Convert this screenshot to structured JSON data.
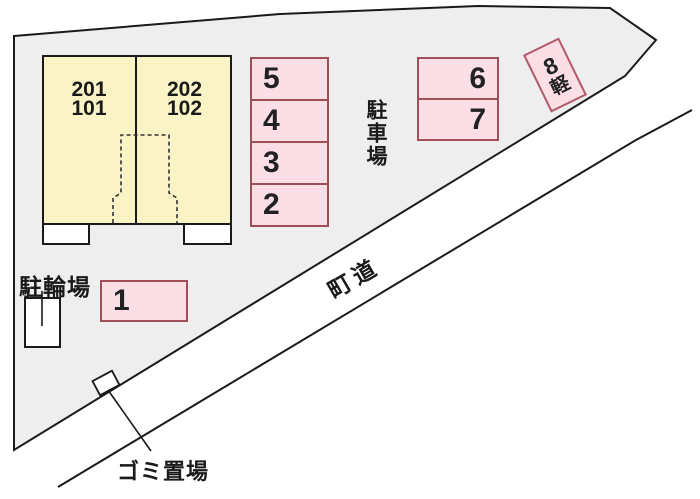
{
  "colors": {
    "site_fill": "#EEEEEE",
    "outline": "#1A1A1A",
    "building_fill": "#FAF3C6",
    "spot_fill": "#FBDEE6",
    "spot_border": "#A04E58"
  },
  "building": {
    "rooms": [
      {
        "upper": "201",
        "lower": "101"
      },
      {
        "upper": "202",
        "lower": "102"
      }
    ]
  },
  "parking": {
    "column_spots": [
      "5",
      "4",
      "3",
      "2"
    ],
    "double_spots": [
      "6",
      "7"
    ],
    "spot_1": "1",
    "spot_8": {
      "number": "8",
      "type_label": "軽"
    }
  },
  "labels": {
    "parking_area": "駐車場",
    "bicycle_area": "駐輪場",
    "town_road": "町道",
    "garbage_area": "ゴミ置場"
  }
}
